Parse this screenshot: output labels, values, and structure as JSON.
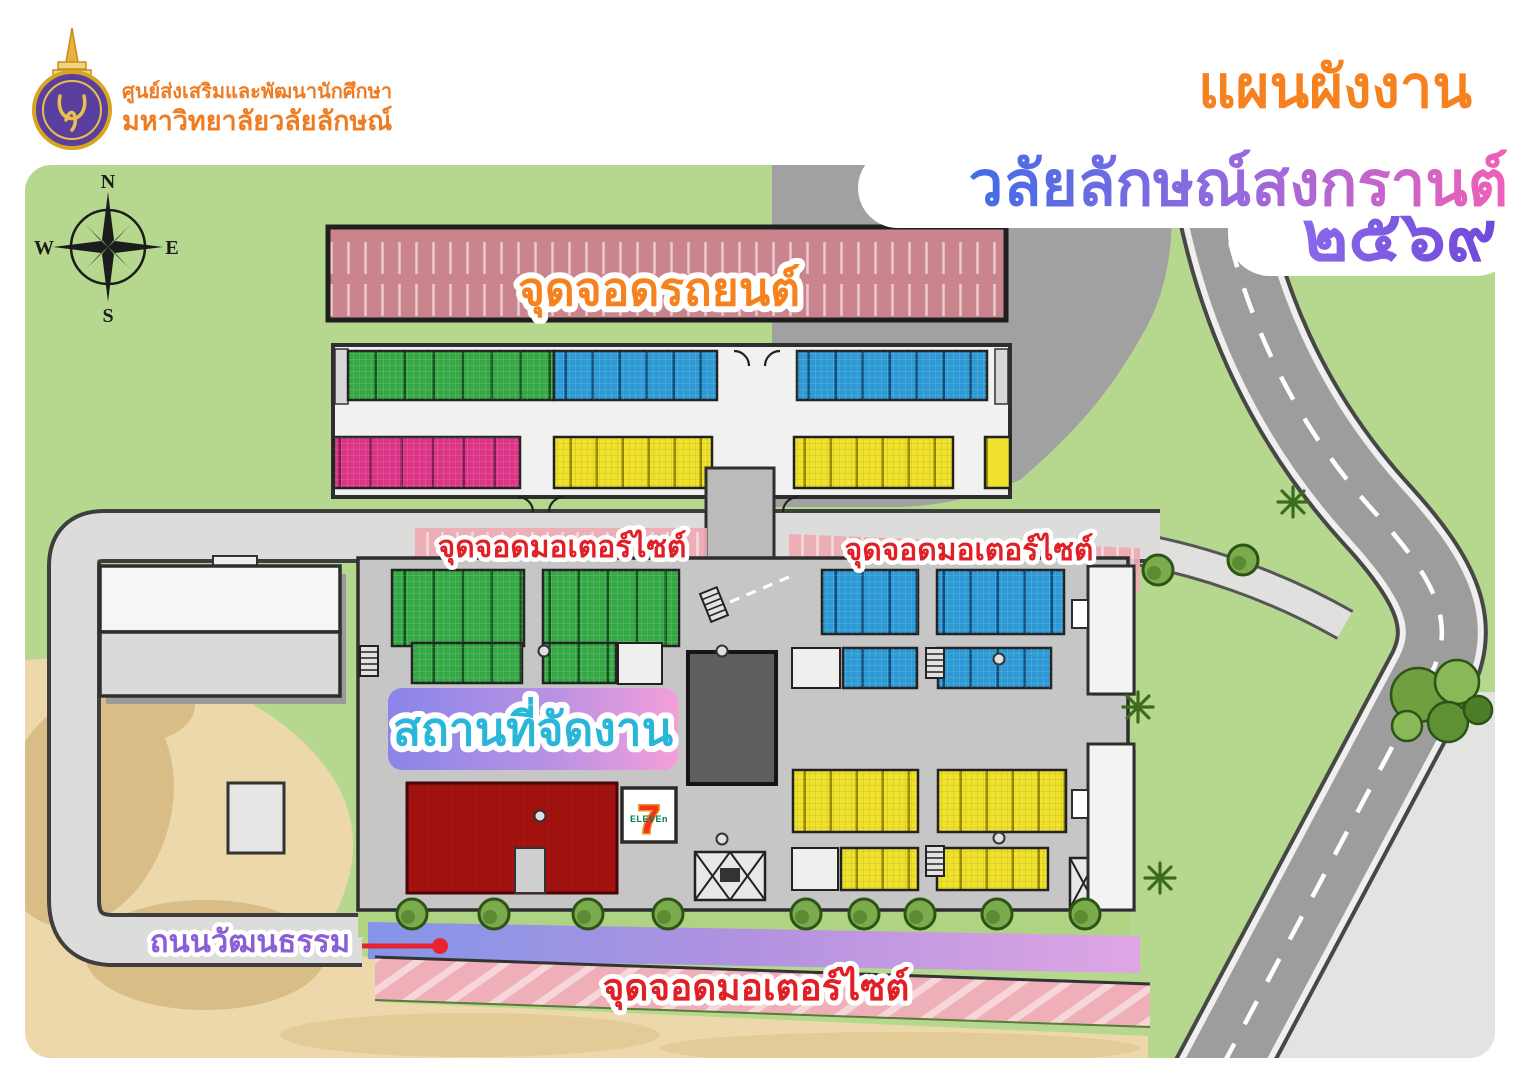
{
  "branding": {
    "org_line1": "ศูนย์ส่งเสริมและพัฒนานักศึกษา",
    "org_line2": "มหาวิทยาลัยวลัยลักษณ์"
  },
  "title": {
    "line1": "แผนผังงาน",
    "line2": "วลัยลักษณ์สงกรานต์",
    "year": "๒๕๖๙"
  },
  "compass": {
    "north": "N",
    "east": "E",
    "south": "S",
    "west": "W"
  },
  "labels": {
    "car_parking": "จุดจอดรถยนต์",
    "motorcycle_parking_left": "จุดจอดมอเตอร์ไซต์",
    "motorcycle_parking_right": "จุดจอดมอเตอร์ไซต์",
    "motorcycle_parking_bottom": "จุดจอดมอเตอร์ไซต์",
    "event_venue": "สถานที่จัดงาน",
    "culture_road": "ถนนวัฒนธรรม"
  },
  "store": {
    "seven": "7",
    "eleven": "ELEVEn"
  },
  "colors": {
    "title_orange": "#F5821F",
    "title_gradient_start": "#3F6DE8",
    "title_gradient_end": "#F060B8",
    "year_purple": "#7A57E0",
    "org_text_orange": "#F07C22",
    "grass": "#B6D88E",
    "sand": "#ECD8AA",
    "road_gray": "#9D9D9D",
    "asphalt": "#A1A1A1",
    "car_parking_zone": "#C9848D",
    "motorcycle_zone": "#EDABB4",
    "green_stalls": "#35A845",
    "blue_stalls": "#2D99D5",
    "pink_stalls": "#DC3487",
    "yellow_stalls": "#F0E22C",
    "red_zone": "#A41310",
    "venue_banner_start": "#8A85E9",
    "venue_banner_end": "#F49FD9",
    "venue_text_cyan": "#2AB6D9",
    "parking_label_red": "#E01F26",
    "culture_road_purple": "#8A5FD6",
    "seven_green": "#007A53",
    "seven_red": "#EE3524"
  }
}
